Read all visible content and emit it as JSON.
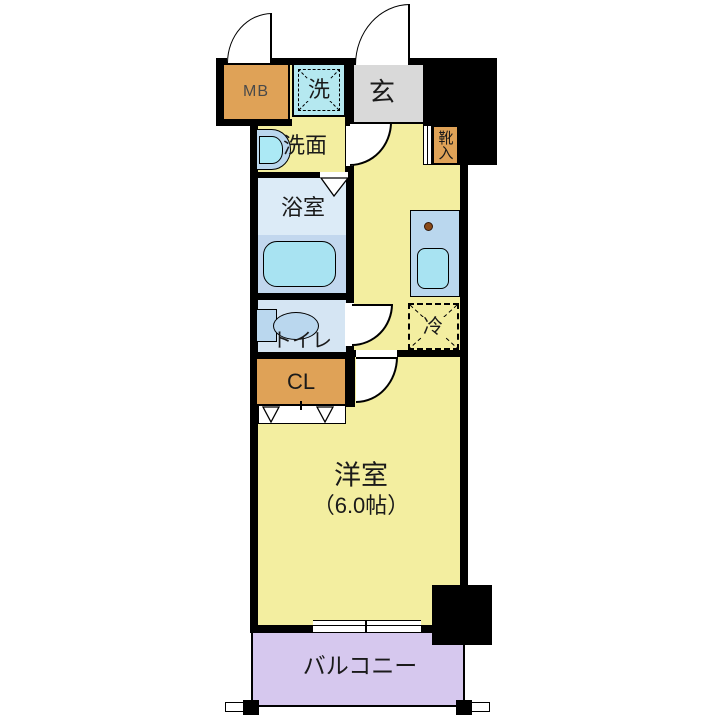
{
  "title": "1K apartment floor plan",
  "rooms": {
    "meter_box": "MB",
    "washer": "洗",
    "entrance": "玄",
    "shoe_cabinet": "靴入",
    "washroom": "洗面",
    "bathroom": "浴室",
    "toilet": "トイレ",
    "closet": "CL",
    "refrigerator": "冷",
    "western_room": "洋室",
    "western_room_size": "（6.0帖）",
    "balcony": "バルコニー"
  },
  "colors": {
    "room_yellow": "#f3eea0",
    "entrance_gray": "#d9d9d9",
    "storage_orange": "#dfa257",
    "bathroom_upper_blue": "#dcebf7",
    "bathroom_lower_blue": "#c2d7ee",
    "fixture_cyan": "#a8e3f2",
    "counter_blue": "#bad7ee",
    "toilet_room_blue": "#d5e5f3",
    "balcony_purple": "#d6c8ee",
    "wall_black": "#000000"
  }
}
